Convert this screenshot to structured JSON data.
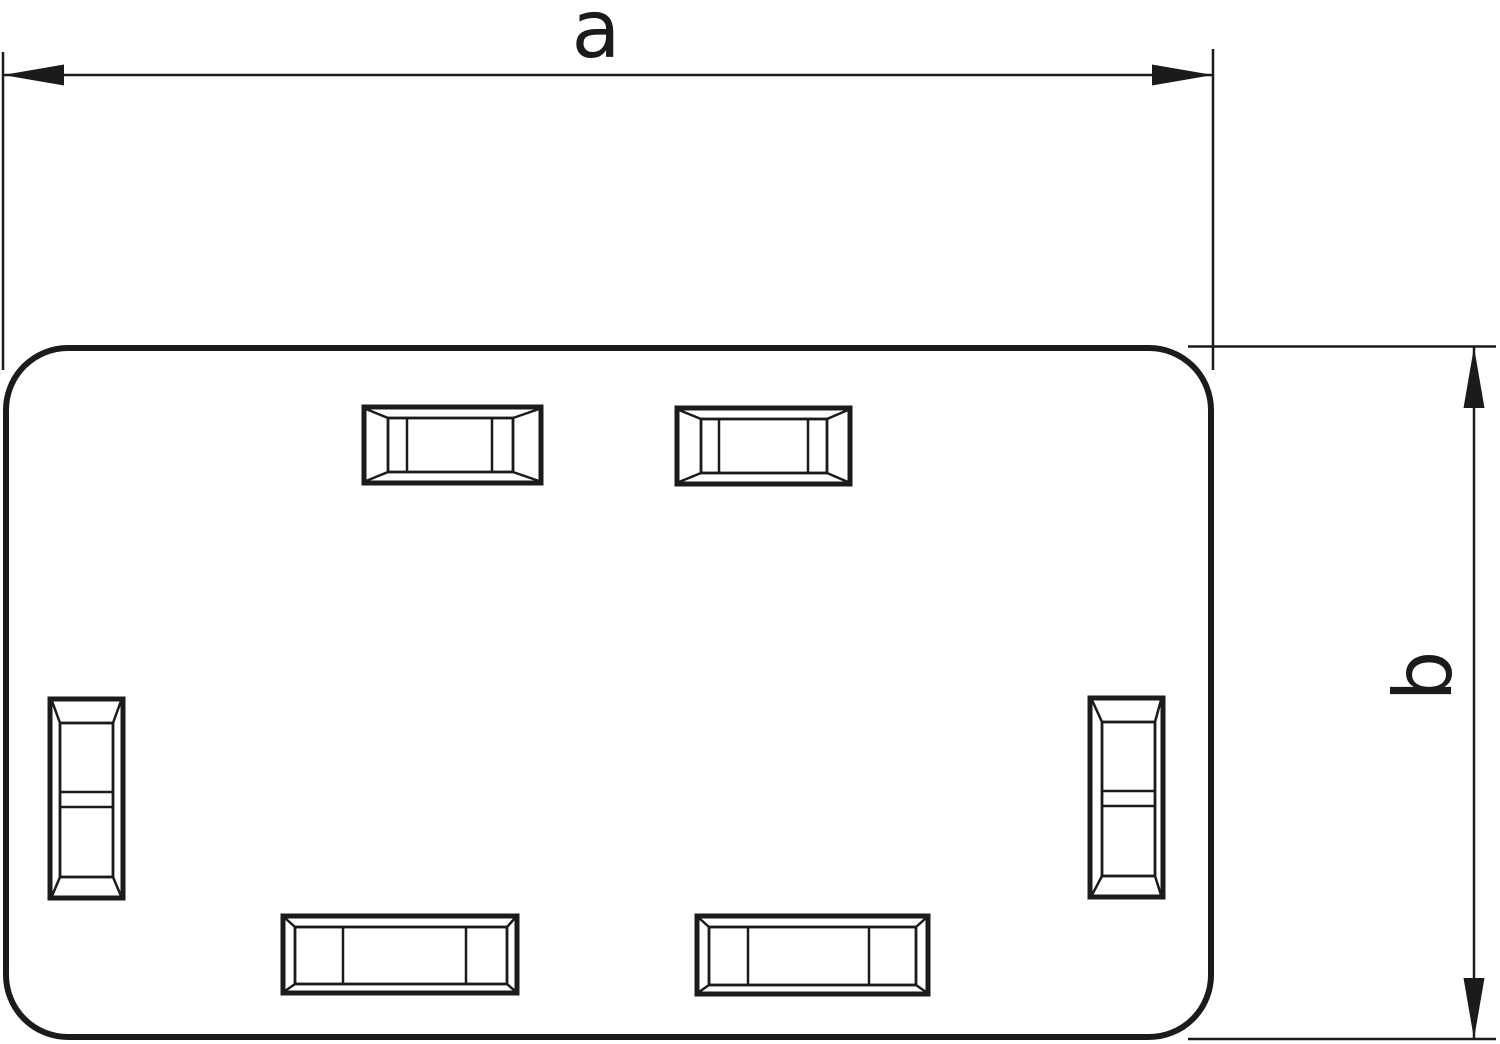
{
  "page": {
    "background": "#ffffff"
  },
  "drawing": {
    "stroke_color": "#1d1a1b",
    "labels": {
      "width_dimension": "a",
      "height_dimension": "b"
    }
  }
}
